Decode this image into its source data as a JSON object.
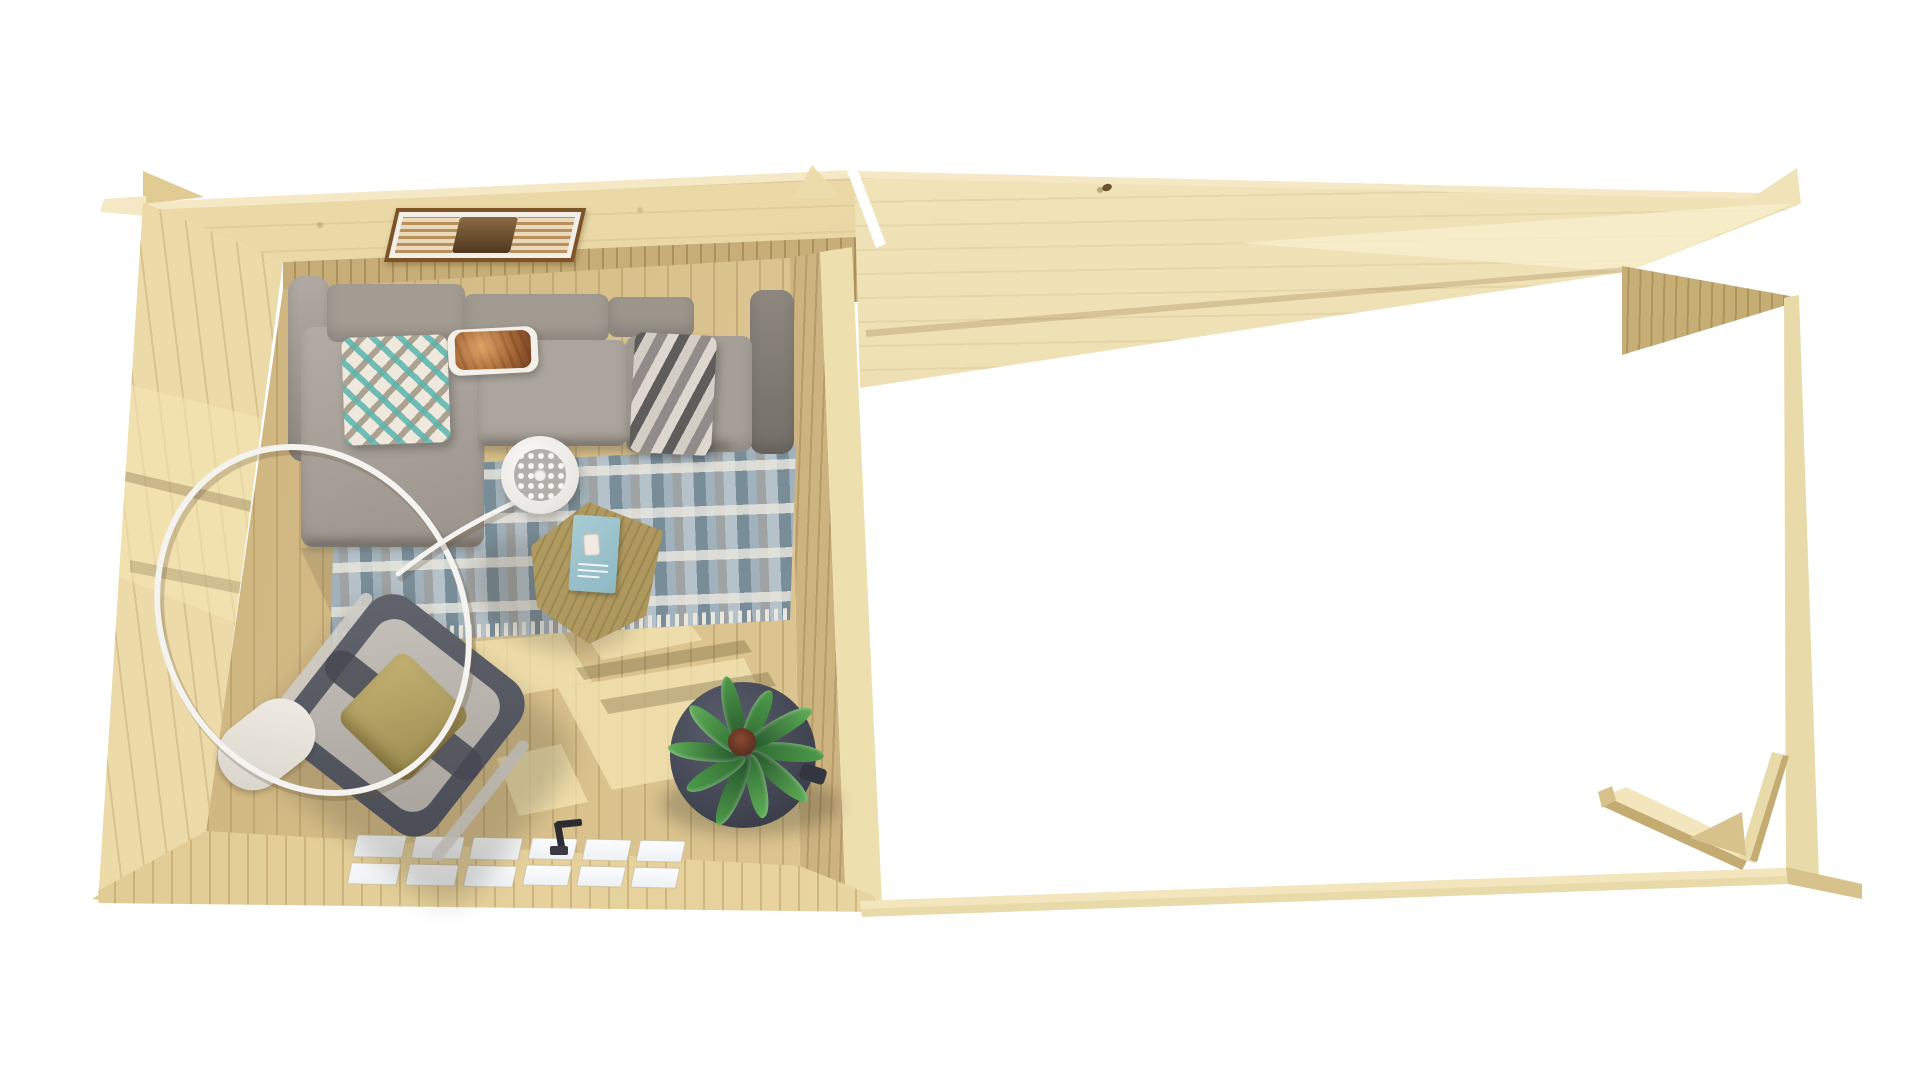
{
  "meta": {
    "type": "3d-product-render",
    "view": "top-down bird's-eye view",
    "background": "#ffffff"
  },
  "labels": {
    "scene": "Wooden log cabin garden room with attached open canopy, viewed from above",
    "cabin": "Furnished log cabin room",
    "canopy": "Open timber canopy frame",
    "sofa": "Gray corner sofa",
    "diamond_pillow": "Teal diamond-pattern cushion",
    "chevron_pillow": "Gray chevron-pattern cushion",
    "copper_bag": "Copper gift bag on white tray",
    "rug": "Blue-gray patterned area rug",
    "coffee_table": "Hexagonal wooden coffee table",
    "book": "Teal magazine",
    "lamp": "White arc floor lamp with perforated shade",
    "chair": "Lounge armchair with olive cushion and white throw",
    "plant": "Green potted plant on dark round side table",
    "door": "Glazed double door with white panes",
    "handle": "Dark door handle",
    "picture": "Framed picture on roof plane",
    "braces": "Diagonal corner braces of canopy post"
  },
  "palette": {
    "bg": "#ffffff",
    "roof-wood": "#ecdcab",
    "roof-wood-dark": "#e2cf97",
    "fascia": "#f4e9c4",
    "wall-wood": "#ecdaa8",
    "wall-wood-dark": "#e0cb93",
    "inner-wall": "#c7ad77",
    "floor-wood": "#dbc48f",
    "floor-shaded": "#c9ae79",
    "sun-light": "#f6e7b5",
    "front-wall": "#e7d29d",
    "front-wall-lit": "#f0dfae",
    "right-wall-shade": "#cdb37f",
    "right-wall-lit": "#eedfae",
    "canopy-roof": "#f0e3b8",
    "canopy-roof-dark": "#e7d7a4",
    "canopy-roof-lit": "#f7eecb",
    "wedge-wood": "#d8c28b",
    "wedge-wood-dark": "#c4ab72",
    "post-wood": "#e9daa9",
    "strip-lit": "#f3e6bd",
    "pane": "#fbfcfe",
    "handle": "#2c2d33",
    "frame-brown": "#7d5426",
    "frame-matte": "#f2efe9",
    "art-tan": "#b98f5c",
    "art-dark": "#50381f",
    "rug-base": "#b6c2ca",
    "rug-fringe": "#e9e6de",
    "pillow-base": "#efe8dd",
    "chevron-dark": "#5f5d5b",
    "tray": "#f3f0ea",
    "table-wood": "#a59055",
    "table-wood-dark": "#8f7c46",
    "book-teal": "#8db8c3",
    "chair-frame": "#4a4c55",
    "chair-cushion": "#a9a59e",
    "chair-pillow": "#9c8c50",
    "throw": "#d8d3ca",
    "plant-table": "#424552",
    "plant-table-dark": "#33363f",
    "pot": "#5c2f1f",
    "leaf-1": "#2f6b33",
    "leaf-2": "#4e9a4a",
    "leaf-3": "#23512a",
    "leaf-4": "#5fae57",
    "lamp-face": "#b3b0ac"
  }
}
